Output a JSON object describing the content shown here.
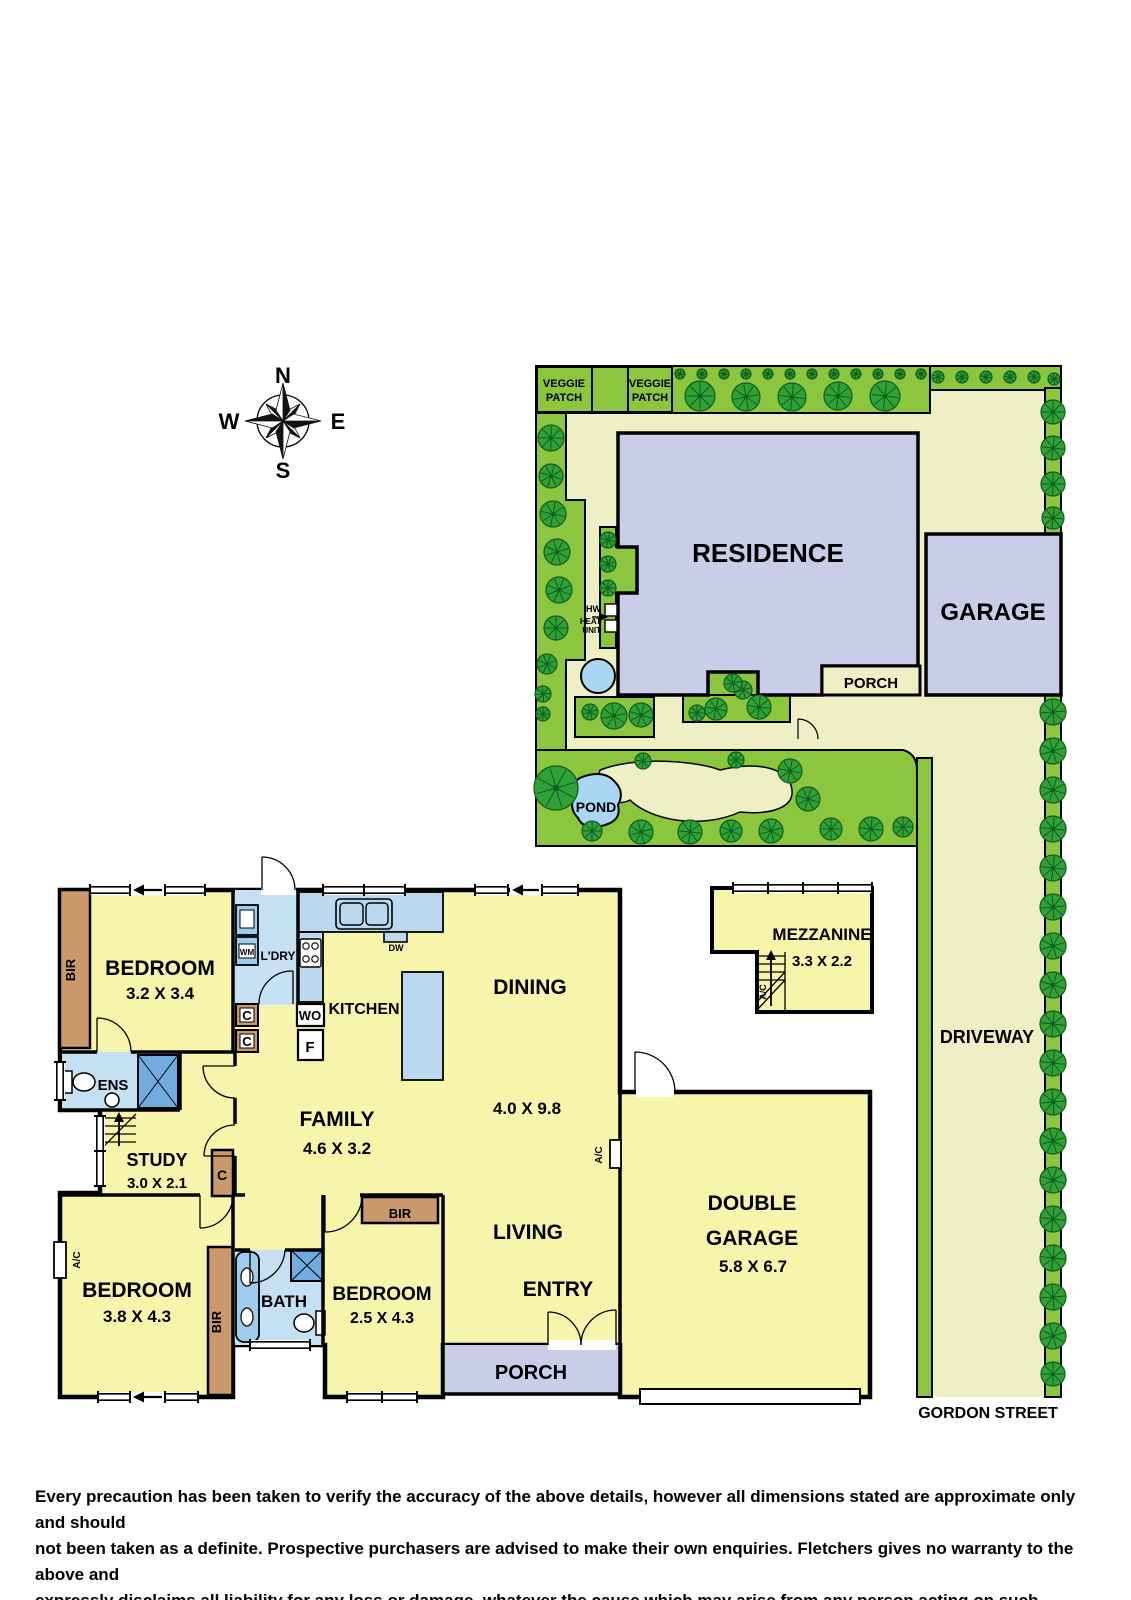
{
  "compass": {
    "n": "N",
    "e": "E",
    "s": "S",
    "w": "W"
  },
  "site": {
    "veggie_patch": {
      "line1": "VEGGIE",
      "line2": "PATCH"
    },
    "residence": "RESIDENCE",
    "garage": "GARAGE",
    "porch": "PORCH",
    "pond": "POND",
    "hw": "HW",
    "heat_unit": {
      "line1": "HEAT",
      "line2": "UNIT"
    },
    "driveway": "DRIVEWAY",
    "street": "GORDON STREET"
  },
  "rooms": {
    "bedroom1": {
      "name": "BEDROOM",
      "dims": "3.2 X 3.4"
    },
    "laundry": {
      "name": "L'DRY",
      "wm": "WM"
    },
    "kitchen": {
      "name": "KITCHEN",
      "dw": "DW",
      "wo": "WO",
      "f": "F",
      "c1": "C",
      "c2": "C"
    },
    "dining": {
      "name": "DINING",
      "dims": "4.0 X 9.8"
    },
    "family": {
      "name": "FAMILY",
      "dims": "4.6 X 3.2"
    },
    "ens": {
      "name": "ENS"
    },
    "study": {
      "name": "STUDY",
      "dims": "3.0 X 2.1",
      "c": "C"
    },
    "bedroom2": {
      "name": "BEDROOM",
      "dims": "3.8 X 4.3",
      "ac": "A/C"
    },
    "bath": {
      "name": "BATH"
    },
    "bedroom3": {
      "name": "BEDROOM",
      "dims": "2.5 X 4.3"
    },
    "living": {
      "name": "LIVING",
      "ac": "A/C"
    },
    "entry": {
      "name": "ENTRY"
    },
    "porch": {
      "name": "PORCH"
    },
    "double_garage": {
      "line1": "DOUBLE",
      "line2": "GARAGE",
      "dims": "5.8 X 6.7"
    },
    "mezzanine": {
      "name": "MEZZANINE",
      "dims": "3.3 X 2.2",
      "ac": "A/C"
    },
    "bir": "BIR"
  },
  "disclaimer": {
    "line1": "Every precaution has been taken to verify the accuracy of the above details, however all dimensions stated are approximate only and should",
    "line2": "not been taken as a definite. Prospective purchasers are advised to make their own enquiries. Fletchers gives no warranty to the above and",
    "line3": "expressly disclaims all liability for any loss or damage, whatever the cause which may arise from any person acting on such statements"
  },
  "colors": {
    "wall": "#000000",
    "site_green": "#8CC63F",
    "tree_green": "#2FA136",
    "tree_dark": "#0E5E1C",
    "yard": "#EFEFC6",
    "floor": "#F7F4AC",
    "building": "#C9CDE8",
    "water": "#A9D6F3",
    "wet_floor": "#C6E0F3",
    "fixture_blue": "#9FCBEC",
    "shower_blue": "#72ACDE",
    "counter_blue": "#BCD8EF",
    "cabinet_brown": "#C9996B"
  }
}
